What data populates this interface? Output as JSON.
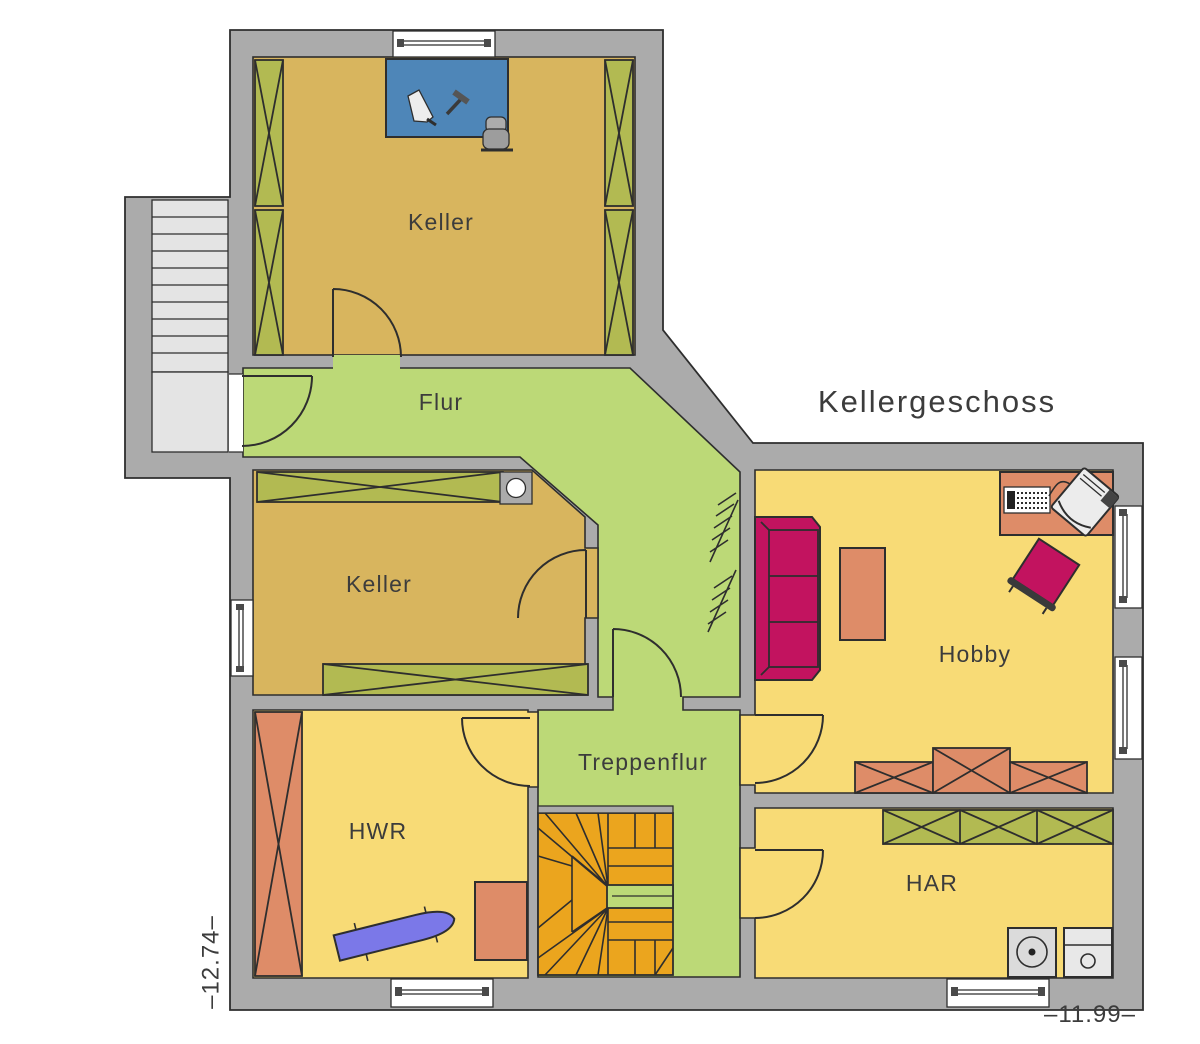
{
  "title": "Kellergeschoss",
  "rooms": {
    "keller_top": "Keller",
    "flur": "Flur",
    "keller_mid": "Keller",
    "hobby": "Hobby",
    "treppenflur": "Treppenflur",
    "hwr": "HWR",
    "har": "HAR"
  },
  "levels": {
    "left": "–12.74–",
    "bottom_right": "–11.99–"
  },
  "colors": {
    "wall": "#ABABAB",
    "line": "#2E2E2E",
    "tread": "#E4E4E4",
    "keller_tan": "#D8B55E",
    "flur_green": "#BCD977",
    "room_yellow": "#F8DB76",
    "shelf_olive": "#B2BA52",
    "furniture_salmon": "#DE8C68",
    "sofa_magenta": "#C2135F",
    "workbench_blue": "#4E86B8",
    "ironing_blue": "#7B78E8",
    "stair_orange": "#EBA51E",
    "appliance_gray": "#DBDBDB",
    "text": "#3C3C3C"
  }
}
